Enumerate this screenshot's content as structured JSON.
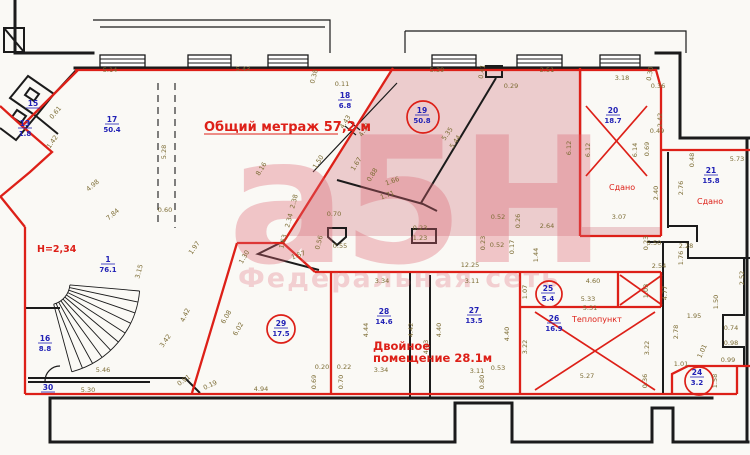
{
  "palette": {
    "wall": "#1b1b1b",
    "red": "#dd2018",
    "blue": "#2121b5",
    "dim_text": "#7c6c34",
    "pink_fill": "rgba(205,100,112,0.30)",
    "watermark_big": "rgba(221,100,115,0.35)",
    "watermark_small": "rgba(221,100,115,0.28)"
  },
  "annotations": [
    {
      "text": "Общий метраж 57,2 м",
      "x": 204,
      "y": 131,
      "style": "total",
      "underline": 134
    },
    {
      "text": "Н=2,34",
      "x": 37,
      "y": 252,
      "style": "note"
    },
    {
      "text": "Сдано",
      "x": 609,
      "y": 190,
      "style": "small"
    },
    {
      "text": "Сдано",
      "x": 697,
      "y": 204,
      "style": "small"
    },
    {
      "text": "Теплопункт",
      "x": 572,
      "y": 322,
      "style": "small"
    },
    {
      "text": "Двойное",
      "x": 373,
      "y": 350,
      "style": "double"
    },
    {
      "text": "помещение 28.1м",
      "x": 373,
      "y": 362,
      "style": "double"
    },
    {
      "text": "а5Н",
      "x": 228,
      "y": 262,
      "style": "wm-big"
    },
    {
      "text": "Федеральная сеть",
      "x": 238,
      "y": 287,
      "style": "wm-small"
    }
  ],
  "rooms": [
    {
      "number": "17",
      "area": "50.4",
      "x": 112,
      "y": 122
    },
    {
      "number": "15",
      "area": null,
      "x": 33,
      "y": 106
    },
    {
      "number": "13",
      "area": "1.8",
      "x": 25,
      "y": 126
    },
    {
      "number": "18",
      "area": "6.8",
      "x": 345,
      "y": 98
    },
    {
      "number": "19",
      "area": "50.8",
      "x": 422,
      "y": 113,
      "marker": {
        "type": "circle",
        "cx": 423,
        "cy": 117,
        "r": 16
      }
    },
    {
      "number": "20",
      "area": "18.7",
      "x": 613,
      "y": 113,
      "marker": {
        "type": "cross",
        "x1": 586,
        "y1": 106,
        "x2": 647,
        "y2": 176
      }
    },
    {
      "number": "21",
      "area": "15.8",
      "x": 711,
      "y": 173
    },
    {
      "number": "1",
      "area": "76.1",
      "x": 108,
      "y": 262
    },
    {
      "number": "16",
      "area": "8.8",
      "x": 45,
      "y": 341
    },
    {
      "number": "30",
      "area": null,
      "x": 48,
      "y": 390
    },
    {
      "number": "29",
      "area": "17.5",
      "x": 281,
      "y": 326,
      "marker": {
        "type": "circle",
        "cx": 281,
        "cy": 329,
        "r": 14
      }
    },
    {
      "number": "28",
      "area": "14.6",
      "x": 384,
      "y": 314
    },
    {
      "number": "27",
      "area": "13.5",
      "x": 474,
      "y": 313
    },
    {
      "number": "25",
      "area": "5.4",
      "x": 548,
      "y": 291,
      "marker": {
        "type": "circle",
        "cx": 549,
        "cy": 294,
        "r": 13
      }
    },
    {
      "number": "26",
      "area": "16.9",
      "x": 554,
      "y": 321,
      "marker": {
        "type": "cross",
        "x1": 535,
        "y1": 312,
        "x2": 655,
        "y2": 390
      }
    },
    {
      "number": "24",
      "area": "3.2",
      "x": 697,
      "y": 375,
      "marker": {
        "type": "circle",
        "cx": 699,
        "cy": 381,
        "r": 14
      }
    }
  ],
  "extra_crosses": [
    {
      "x1": 620,
      "y1": 275,
      "x2": 662,
      "y2": 305
    }
  ],
  "dimensions": [
    [
      "5.14",
      110,
      72,
      0
    ],
    [
      "5.43",
      243,
      71,
      0
    ],
    [
      "0.38",
      316,
      77,
      -75
    ],
    [
      "0.11",
      342,
      86,
      0
    ],
    [
      "5.39",
      437,
      72,
      0
    ],
    [
      "0.41",
      484,
      72,
      -80
    ],
    [
      "0.29",
      511,
      88,
      0
    ],
    [
      "2.51",
      547,
      72,
      0
    ],
    [
      "3.18",
      622,
      80,
      0
    ],
    [
      "0.30",
      652,
      74,
      -80
    ],
    [
      "0.36",
      658,
      88,
      0
    ],
    [
      "2.42",
      662,
      120,
      -90
    ],
    [
      "0.49",
      657,
      133,
      0
    ],
    [
      "6.12",
      571,
      148,
      -90
    ],
    [
      "6.12",
      590,
      150,
      -90
    ],
    [
      "6.14",
      637,
      150,
      -90
    ],
    [
      "0.69",
      649,
      149,
      -90
    ],
    [
      "2.40",
      658,
      193,
      -90
    ],
    [
      "3.07",
      619,
      219,
      0
    ],
    [
      "5.73",
      737,
      161,
      0
    ],
    [
      "0.48",
      694,
      160,
      -90
    ],
    [
      "2.76",
      683,
      188,
      -90
    ],
    [
      "0.61",
      57,
      114,
      -50
    ],
    [
      "1.42",
      54,
      143,
      -55
    ],
    [
      "4.98",
      94,
      187,
      -40
    ],
    [
      "7.84",
      114,
      216,
      -40
    ],
    [
      "5.28",
      166,
      152,
      -90
    ],
    [
      "0.60",
      165,
      212,
      0
    ],
    [
      "1.97",
      196,
      249,
      -55
    ],
    [
      "3.15",
      141,
      272,
      -75
    ],
    [
      "4.42",
      187,
      316,
      -65
    ],
    [
      "3.42",
      167,
      342,
      -55
    ],
    [
      "5.46",
      103,
      372,
      0
    ],
    [
      "0.91",
      185,
      382,
      -35
    ],
    [
      "0.19",
      211,
      387,
      -25
    ],
    [
      "5.30",
      88,
      392,
      0
    ],
    [
      "4.94",
      261,
      391,
      0
    ],
    [
      "8.16",
      263,
      170,
      -58
    ],
    [
      "1.50",
      320,
      163,
      -58
    ],
    [
      "4.43",
      347,
      123,
      -58
    ],
    [
      "4.59",
      366,
      131,
      -58
    ],
    [
      "1.67",
      358,
      165,
      -58
    ],
    [
      "0.88",
      374,
      176,
      -58
    ],
    [
      "1.66",
      393,
      183,
      -20
    ],
    [
      "1.71",
      388,
      197,
      -20
    ],
    [
      "5.35",
      449,
      135,
      -55
    ],
    [
      "5.44",
      457,
      143,
      -55
    ],
    [
      "0.70",
      334,
      216,
      0
    ],
    [
      "2.38",
      296,
      202,
      -75
    ],
    [
      "2.34",
      291,
      221,
      -75
    ],
    [
      "1.63",
      285,
      242,
      -75
    ],
    [
      "0.56",
      321,
      243,
      -75
    ],
    [
      "0.55",
      340,
      248,
      0
    ],
    [
      "1.30",
      246,
      258,
      -60
    ],
    [
      "1.57",
      299,
      257,
      -20
    ],
    [
      "0.23",
      420,
      230,
      0
    ],
    [
      "1.23",
      420,
      240,
      0
    ],
    [
      "0.52",
      498,
      219,
      0
    ],
    [
      "0.26",
      520,
      221,
      -90
    ],
    [
      "2.64",
      547,
      228,
      0
    ],
    [
      "0.23",
      485,
      243,
      -90
    ],
    [
      "0.52",
      497,
      247,
      0
    ],
    [
      "0.17",
      514,
      247,
      -90
    ],
    [
      "1.44",
      538,
      255,
      -90
    ],
    [
      "5.50",
      654,
      245,
      0
    ],
    [
      "12.25",
      470,
      267,
      0
    ],
    [
      "1.07",
      527,
      292,
      -90
    ],
    [
      "4.60",
      593,
      283,
      0
    ],
    [
      "5.33",
      588,
      301,
      0
    ],
    [
      "1.03",
      648,
      291,
      -90
    ],
    [
      "5.31",
      590,
      310,
      0
    ],
    [
      "3.22",
      527,
      347,
      -90
    ],
    [
      "3.22",
      649,
      348,
      -90
    ],
    [
      "5.27",
      587,
      378,
      0
    ],
    [
      "1.95",
      694,
      318,
      0
    ],
    [
      "2.78",
      678,
      332,
      -90
    ],
    [
      "4.77",
      667,
      293,
      -90
    ],
    [
      "2.54",
      659,
      268,
      0
    ],
    [
      "1.76",
      683,
      258,
      -90
    ],
    [
      "2.28",
      686,
      248,
      0
    ],
    [
      "0.23",
      648,
      243,
      -90
    ],
    [
      "2.52",
      744,
      278,
      -90
    ],
    [
      "1.50",
      718,
      302,
      -90
    ],
    [
      "0.74",
      731,
      330,
      0
    ],
    [
      "0.98",
      731,
      345,
      0
    ],
    [
      "1.01",
      704,
      352,
      -65
    ],
    [
      "0.99",
      728,
      362,
      0
    ],
    [
      "1.01",
      681,
      366,
      0
    ],
    [
      "0.36",
      647,
      381,
      -90
    ],
    [
      "1.58",
      717,
      381,
      -90
    ],
    [
      "3.34",
      382,
      283,
      0
    ],
    [
      "3.11",
      472,
      283,
      0
    ],
    [
      "4.44",
      368,
      330,
      -90
    ],
    [
      "4.42",
      413,
      330,
      -90
    ],
    [
      "4.43",
      428,
      347,
      -90
    ],
    [
      "4.40",
      441,
      330,
      -90
    ],
    [
      "4.40",
      509,
      334,
      -90
    ],
    [
      "0.20",
      322,
      369,
      0
    ],
    [
      "0.22",
      344,
      369,
      0
    ],
    [
      "3.34",
      381,
      372,
      0
    ],
    [
      "0.69",
      316,
      382,
      -90
    ],
    [
      "0.70",
      343,
      382,
      -90
    ],
    [
      "3.11",
      477,
      373,
      0
    ],
    [
      "0.80",
      484,
      382,
      -90
    ],
    [
      "0.53",
      498,
      370,
      0
    ],
    [
      "6.08",
      228,
      318,
      -60
    ],
    [
      "6.02",
      240,
      330,
      -60
    ]
  ]
}
